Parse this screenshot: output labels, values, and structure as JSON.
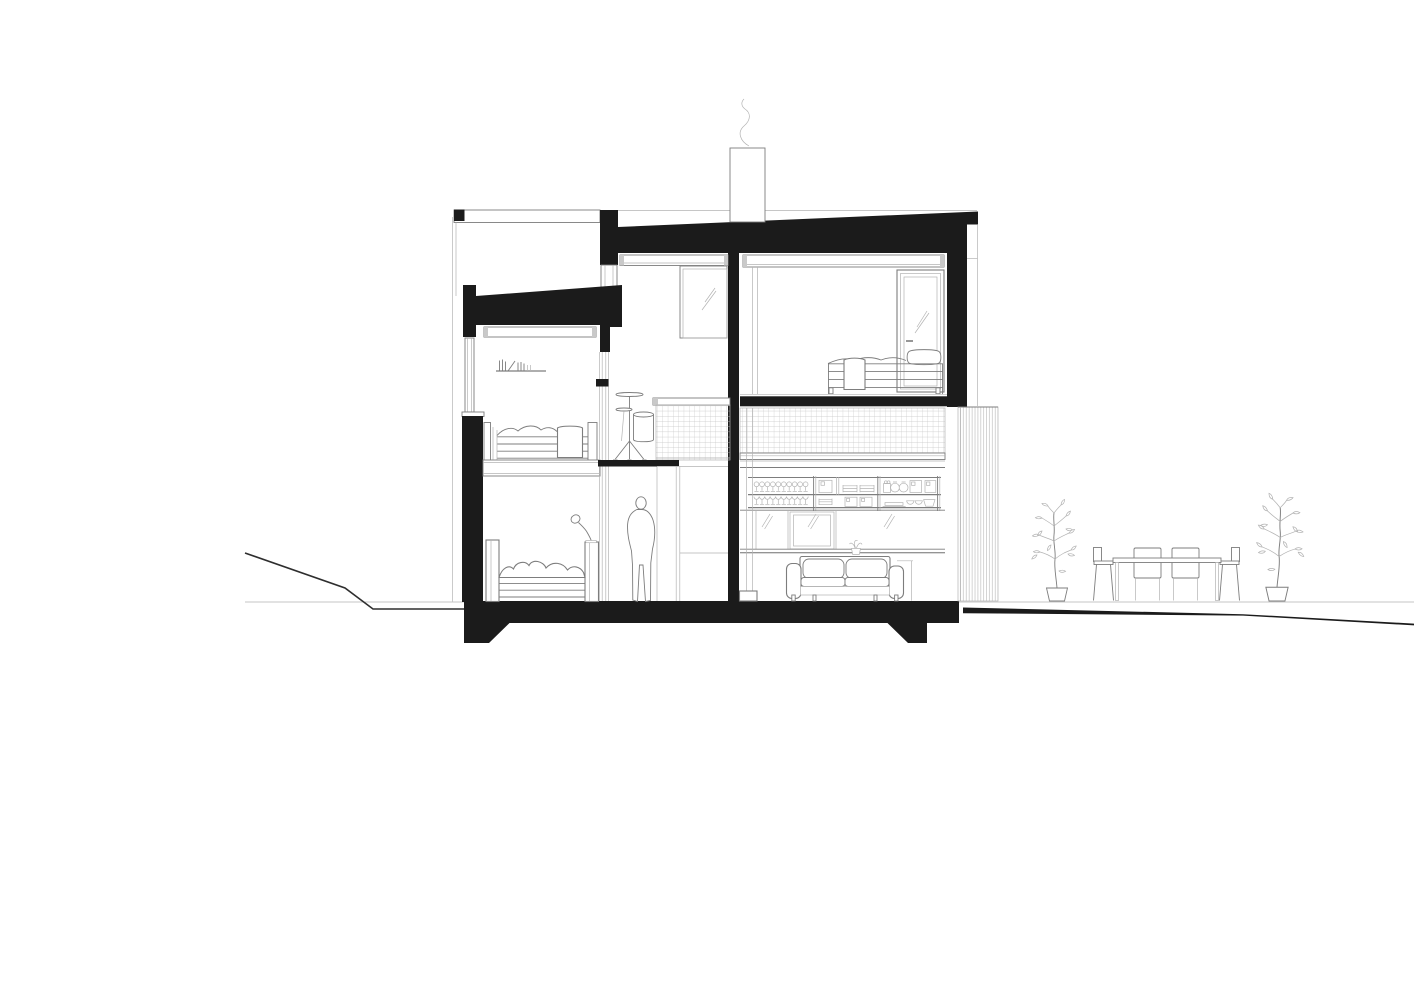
{
  "meta": {
    "title": "House cross-section (architectural section drawing)",
    "drawing_type": "technical line drawing, black ink on white paper",
    "visible_text": "none"
  },
  "colors": {
    "paper": "#ffffff",
    "ink": "#1b1b1b",
    "line": "#7d7d7d",
    "line_light": "#b3b3b3",
    "line_dark": "#2e2e2e",
    "cap": "#c9c9c9"
  },
  "scene": {
    "structure": [
      "sloped flat roof cut in section (solid black)",
      "lower roof over left bedroom wing (solid black wedge)",
      "left exterior wall with window band",
      "right exterior wall (solid black) with corner parapet",
      "central interior wall (solid black, full height)",
      "foundation slab with two strip footings",
      "chimney with smoke above roof",
      "vertical board siding panel outside right wall"
    ],
    "interior": [
      "upper-left mezzanine bedroom: wall shelf with books, single bed with towel",
      "lower-left bedroom: bed with rumpled duvet, headboard, nightstand with desk lamp",
      "middle hall: standing person silhouette, drum kit with cymbals and bass drum on mezzanine, tall cabinet",
      "upper-middle room: mirror/picture on central wall, clerestory window band",
      "upper-right bedroom: double bed with pillow and towel, glazed door, window band",
      "tiled balustrade/wall band at mezzanine level (square grid)",
      "kitchen: open shelving with wine glasses, plates, jars, canisters, bowls and tray; glazed wall below; counter",
      "living area: sofa with two cushions, armrests, small plant cup, side table"
    ],
    "exterior": [
      "ground line left with sloping terrain",
      "ground line right with thin tapering terrain wedge",
      "two potted plants",
      "outdoor dining table with four chairs"
    ]
  }
}
